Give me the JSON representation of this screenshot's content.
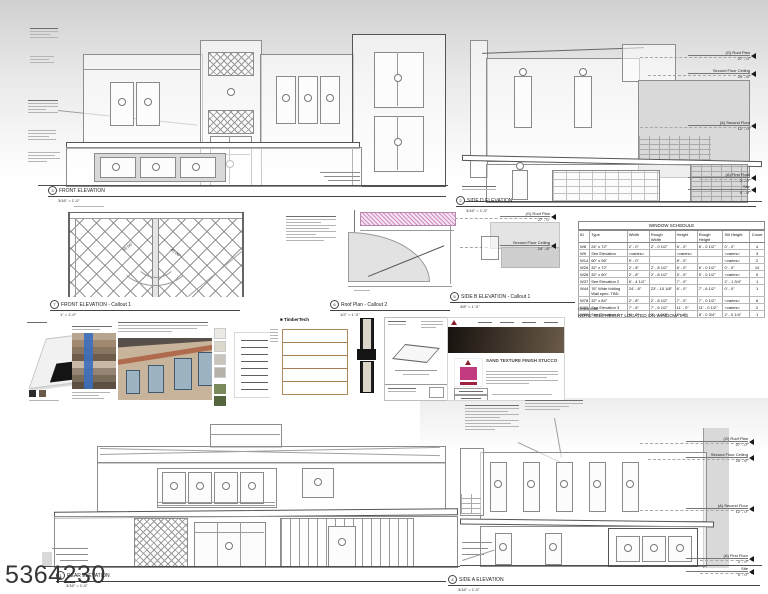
{
  "watermark": "5364230",
  "views": {
    "front": {
      "num": "3",
      "title": "FRONT ELEVATION",
      "scale": "3/16\" = 1'-0\""
    },
    "side_d": {
      "num": "2",
      "title": "SIDE D ELEVATION",
      "scale": "3/16\" = 1'-0\""
    },
    "front_callout": {
      "num": "7",
      "title": "FRONT ELEVATION - Callout 1",
      "scale": "1\" = 1'-0\""
    },
    "roof_callout": {
      "num": "6",
      "title": "Roof Plan - Callout 2",
      "scale": "1/2\" = 1'-0\""
    },
    "side_b_callout": {
      "num": "5",
      "title": "SIDE B ELEVATION - Callout 1",
      "scale": "3/8\" = 1'-0\""
    },
    "rear": {
      "num": "1",
      "title": "REAR ELEVATION",
      "scale": "3/16\" = 1'-0\""
    },
    "side_a": {
      "num": "4",
      "title": "SIDE A ELEVATION",
      "scale": "3/16\" = 1'-0\""
    }
  },
  "callout": {
    "angle1": "45.00°",
    "angle2": "45.00°"
  },
  "levels": {
    "side_d": [
      {
        "name": "(G) Roof Plan",
        "elev": "27' - 0\""
      },
      {
        "name": "Second Floor Ceiling",
        "elev": "24' - 6\""
      },
      {
        "name": "(A) Second Floor",
        "elev": "12' - 0\""
      },
      {
        "name": "(A) First Floor",
        "elev": "2' - 0\""
      },
      {
        "name": "Site",
        "elev": "0' - 0\""
      }
    ],
    "side_a": [
      {
        "name": "(G) Roof Plan",
        "elev": "27' - 0\""
      },
      {
        "name": "Second Floor Ceiling",
        "elev": "24' - 6\""
      },
      {
        "name": "(A) Second Floor",
        "elev": "12' - 0\""
      },
      {
        "name": "(A) First Floor",
        "elev": "2' - 0\""
      },
      {
        "name": "Site",
        "elev": "0' - 0\""
      }
    ],
    "side_b": [
      {
        "name": "(G) Roof Plan",
        "elev": "27' - 0\""
      },
      {
        "name": "Second Floor Ceiling",
        "elev": "24' - 6\""
      }
    ]
  },
  "schedule": {
    "title": "WINDOW SCHEDULE",
    "columns": [
      "ID",
      "Type",
      "Width",
      "Rough Width",
      "Height",
      "Rough Height",
      "Sill Height",
      "Count"
    ],
    "rows": [
      [
        "W8",
        "24\" x 72\"",
        "2' - 0\"",
        "2' - 0 1/2\"",
        "6' - 0\"",
        "6' - 0 1/2\"",
        "0' - 0\"",
        "4"
      ],
      [
        "W9",
        "See Elevation",
        "<varies>",
        "",
        "<varies>",
        "",
        "<varies>",
        "3"
      ],
      [
        "W14",
        "60\" x 96\"",
        "5' - 0\"",
        "",
        "8' - 0\"",
        "",
        "<varies>",
        "2"
      ],
      [
        "W26",
        "32\" x 72\"",
        "2' - 8\"",
        "2' - 8 1/2\"",
        "6' - 0\"",
        "6' - 0 1/2\"",
        "0' - 0\"",
        "14"
      ],
      [
        "W28",
        "32\" x 60\"",
        "2' - 8\"",
        "2' - 8 1/2\"",
        "5' - 0\"",
        "5' - 0 1/2\"",
        "<varies>",
        "5"
      ],
      [
        "W37",
        "See Elevation 2",
        "6' - 4 1/2\"",
        "",
        "7' - 0\"",
        "",
        "2' - 1 3/4\"",
        "1"
      ],
      [
        "W44",
        "76\" Wide folding Wall spec. TBD",
        "24' - 8\"",
        "23' - 10 1/8\"",
        "6' - 0\"",
        "7' - 6 1/2\"",
        "0' - 0\"",
        "1"
      ],
      [
        "W78",
        "32\" x 84\"",
        "2' - 8\"",
        "2' - 8 1/2\"",
        "7' - 0\"",
        "7' - 0 1/2\"",
        "<varies>",
        "6"
      ],
      [
        "W80",
        "See Elevation 3",
        "7' - 6\"",
        "7' - 6 1/2\"",
        "11' - 0\"",
        "11' - 0 1/2\"",
        "<varies>",
        "2"
      ],
      [
        "W81",
        "See Elevation 4",
        "6' - 0\"",
        "2' - 1 1/2\"",
        "8' - 6\"",
        "8' - 0 3/4\"",
        "2' - 0 1/4\"",
        "1"
      ]
    ],
    "grand_total": "Grand total",
    "note": "NOTE: SILL HEIGHT LOCATED ON WINDOW TAG"
  },
  "materials": {
    "timbertech_brand": "TimberTech",
    "stucco_heading": "SAND TEXTURE FINISH STUCCO"
  },
  "colors": {
    "accent_maroon": "#8a1f2d",
    "accent_magenta": "#c23a80",
    "stucco_tan": "#c8b49b",
    "window_blue": "#9db3c2",
    "drawing_gray": "#d9d9d9"
  }
}
